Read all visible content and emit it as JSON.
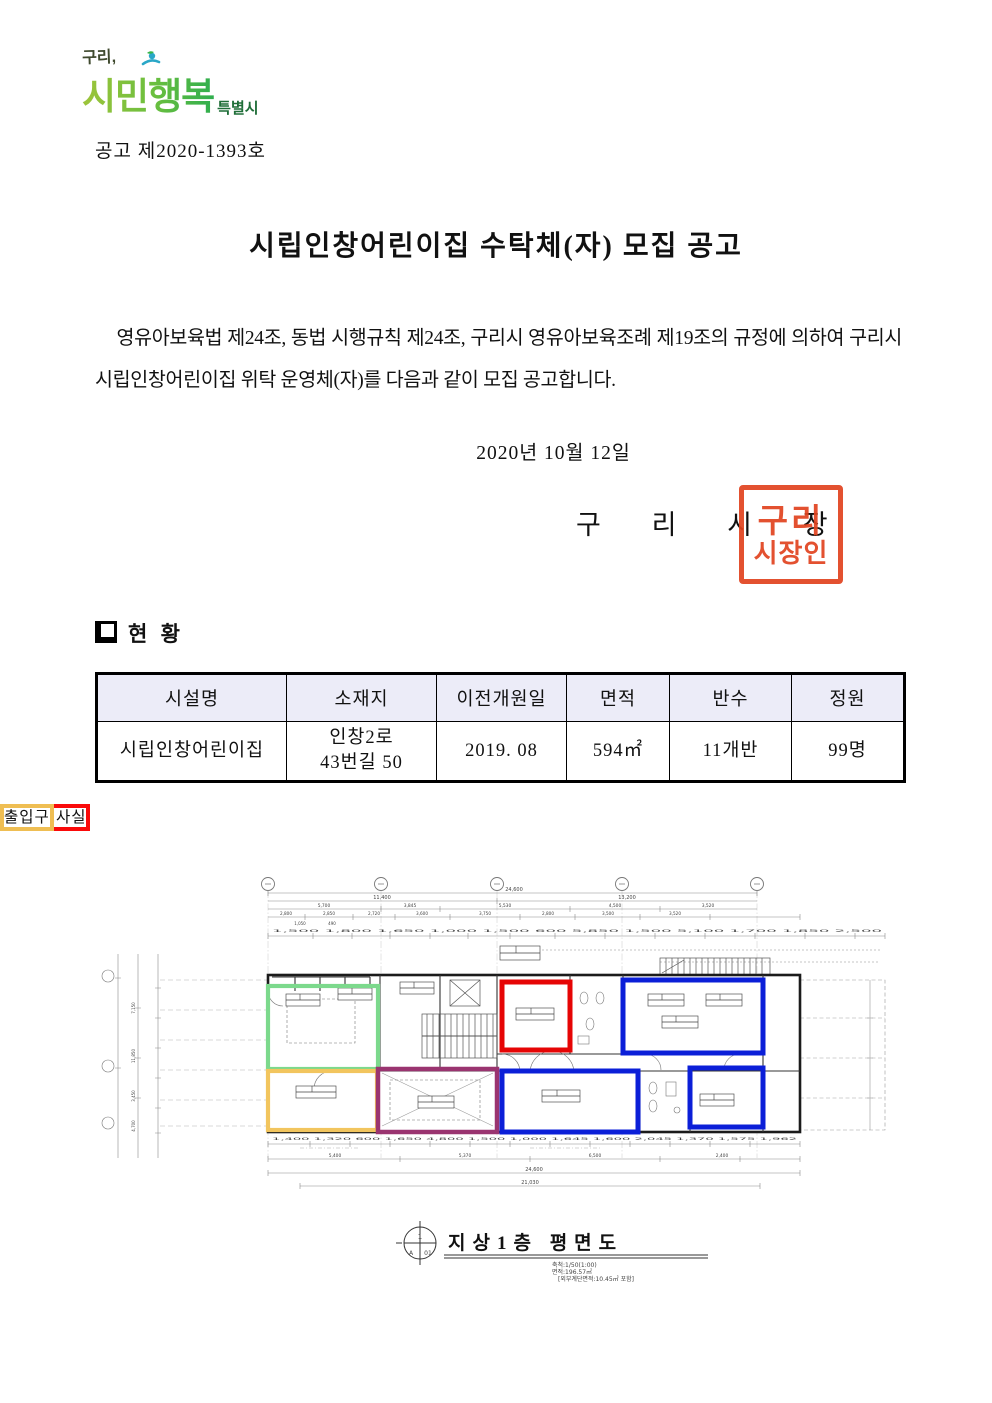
{
  "logo": {
    "prefix": "구리,",
    "main": "시민행복",
    "suffix": "특별시"
  },
  "doc_no": "공고 제2020-1393호",
  "title": "시립인창어린이집 수탁체(자) 모집 공고",
  "body": "영유아보육법 제24조, 동법 시행규칙 제24조, 구리시 영유아보육조례 제19조의 규정에 의하여 구리시 시립인창어린이집 위탁 운영체(자)를 다음과 같이 모집 공고합니다.",
  "date": "2020년  10월  12일",
  "signature": {
    "name": "구 리 시 장",
    "seal_top": "구리",
    "seal_bottom": "시장인",
    "seal_color": "#e1431f"
  },
  "section_title": "현 황",
  "table": {
    "headers": [
      "시설명",
      "소재지",
      "이전개원일",
      "면적",
      "반수",
      "정원"
    ],
    "row": {
      "name": "시립인창어린이집",
      "address": "인창2로\n43번길 50",
      "open_date": "2019. 08",
      "area": "594㎡",
      "classes": "11개반",
      "capacity": "99명"
    }
  },
  "legend": {
    "items": [
      {
        "label": "보육실",
        "color": "#0f14e8"
      },
      {
        "label": "원장·교사실",
        "color": "#fa0a0a"
      },
      {
        "label": "주방",
        "color": "#2ee82e"
      },
      {
        "label": "유희실",
        "color": "#dfa0da"
      },
      {
        "label": "출입구",
        "color": "#efbe53"
      }
    ]
  },
  "floor_plan": {
    "caption": "지상1층 평면도",
    "scale_note": "축척:1/50(1:00)",
    "area_note": "면적:196.57㎡",
    "sub_note": "[외부계단면적:10.45㎡ 포함]",
    "compass": {
      "top": "1",
      "left": "A",
      "right": "01"
    },
    "overlays": [
      {
        "name": "kitchen",
        "legend": "주방",
        "color": "#7cd98c"
      },
      {
        "name": "office",
        "legend": "원장·교사실",
        "color": "#e60505"
      },
      {
        "name": "nursery-1",
        "legend": "보육실",
        "color": "#0b1fd8"
      },
      {
        "name": "entrance",
        "legend": "출입구",
        "color": "#f2c55e"
      },
      {
        "name": "playroom",
        "legend": "유희실",
        "color": "#9a3470"
      },
      {
        "name": "nursery-2",
        "legend": "보육실",
        "color": "#0b1fd8"
      },
      {
        "name": "nursery-3",
        "legend": "보육실",
        "color": "#0b1fd8"
      }
    ],
    "dims": {
      "total": "24,600",
      "left_half": "11,400",
      "right_half": "13,200",
      "tier3": [
        "5,700",
        "3,845",
        "5,530",
        "4,500",
        "3,520"
      ],
      "tier4": [
        "2,800",
        "2,850",
        "2,720",
        "3,600",
        "3,750",
        "2,800",
        "3,500",
        "3,520"
      ],
      "small": [
        "1,050",
        "490"
      ],
      "chain_top": "1,500  1,800  1,650  1,000  1,500  600  5,850  1,500  5,100  1,700  1,850  2,500",
      "bottom_chain": "1,400  1,320  600  1,650  4,800  1,500  1,000  1,645  1,600  2,045  1,370  1,575  1,962",
      "bottom1": [
        "5,400",
        "5,370",
        "6,500",
        "2,400"
      ],
      "bottom_total": "24,600",
      "bottom_overall": "21,030",
      "left": [
        "7,150",
        "11,850",
        "3,450",
        "4,700"
      ]
    }
  }
}
